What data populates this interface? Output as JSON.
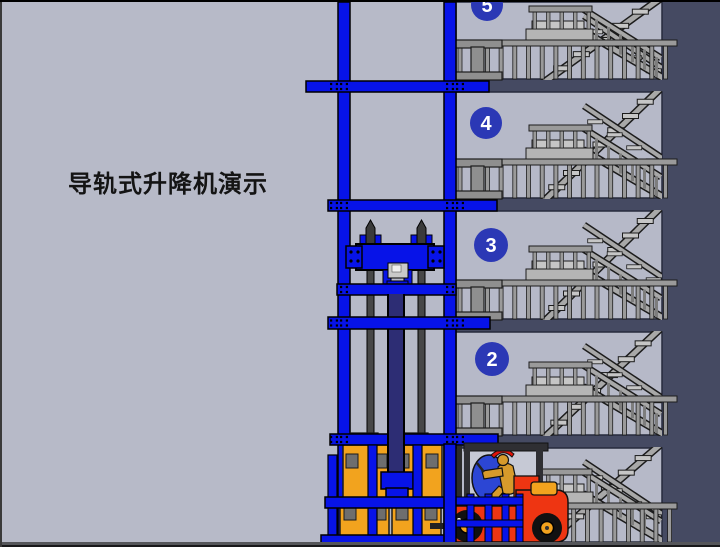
{
  "title": {
    "text": "导轨式升降机演示"
  },
  "building": {
    "floor_badges": [
      {
        "label": "5"
      },
      {
        "label": "4"
      },
      {
        "label": "3"
      },
      {
        "label": "2"
      }
    ]
  },
  "colors": {
    "page_background": "#b7bac8",
    "wall_light": "#b6b9c8",
    "backdrop_dark": "#454a62",
    "structure_blue": "#0713e8",
    "badge_blue": "#2b38b5",
    "badge_text": "#ffffff",
    "rail_gray": "#9a9a9a",
    "landing_gray": "#c6c6c6",
    "bracket_gray": "#8f8f8f",
    "cargo_orange": "#f2a31e",
    "pad_gray": "#6e6e6e",
    "forklift_red": "#ee3512",
    "hub_orange": "#f2a31e",
    "channel_navy": "#2d2d74",
    "rod_gray": "#474747",
    "cab_window": "#c6c9d5",
    "driver_tan": "#d79a2b",
    "cap_red": "#e01309",
    "seat_blue": "#2c46d4",
    "ground_line": "#55565a",
    "ground_dark": "#18181a"
  }
}
